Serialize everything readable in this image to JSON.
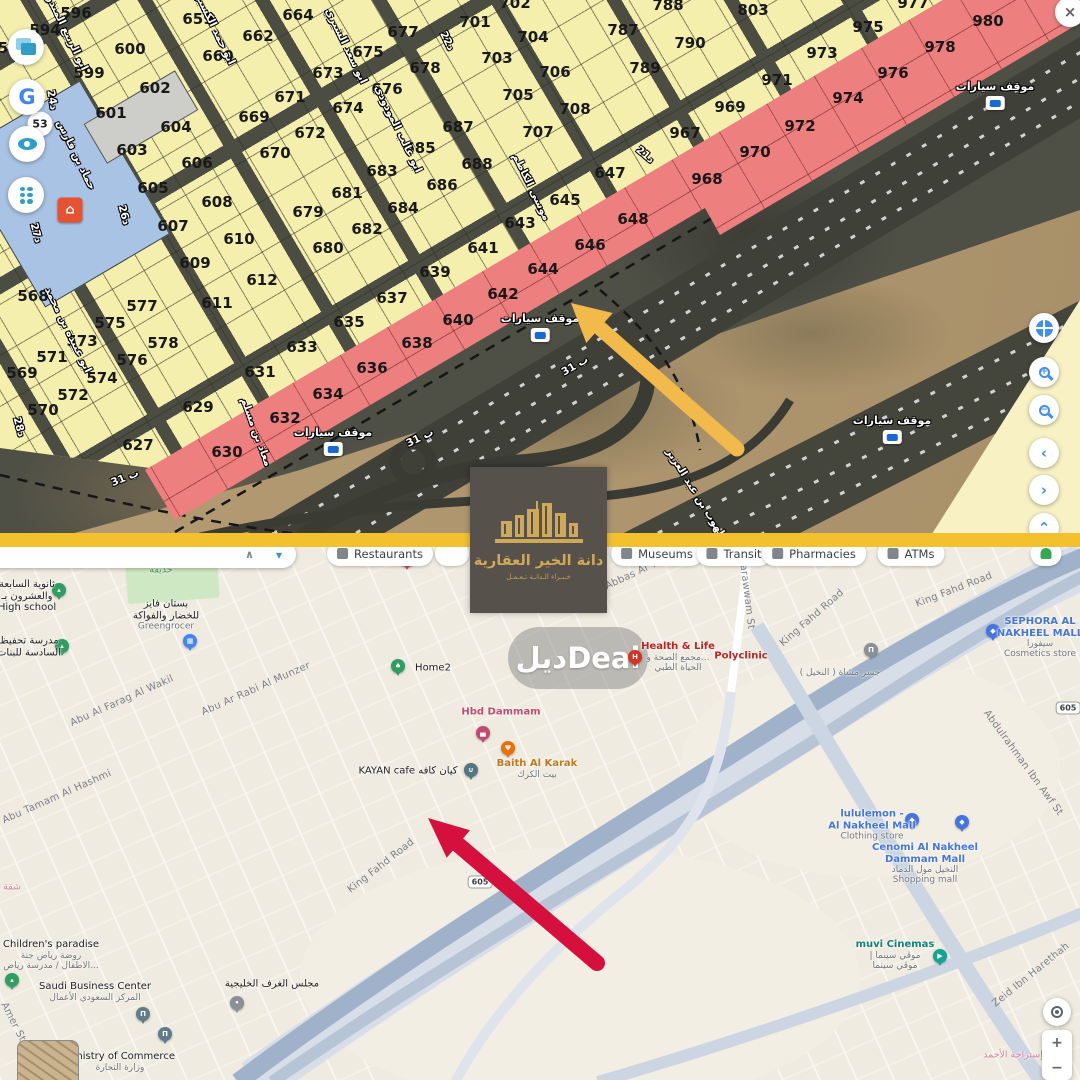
{
  "divider_color": "#f3c12e",
  "logo": {
    "title": "دانة الخير العقارية",
    "tagline": "خـبـراء الـدانـة تـعـمـل"
  },
  "watermark": {
    "text": "ديلDeal"
  },
  "top_map": {
    "badge_53": "53",
    "parking_label": "موقف سيارات",
    "parkings": [
      [
        995,
        95
      ],
      [
        540,
        327
      ],
      [
        892,
        429
      ],
      [
        333,
        441
      ]
    ],
    "parcels": [
      [
        "5",
        3,
        48,
        0
      ],
      [
        "594",
        45,
        30,
        0
      ],
      [
        "596",
        76,
        13,
        0
      ],
      [
        "599",
        89,
        73,
        0
      ],
      [
        "600",
        130,
        49,
        0
      ],
      [
        "601",
        111,
        113,
        0
      ],
      [
        "602",
        155,
        88,
        0
      ],
      [
        "603",
        132,
        150,
        0
      ],
      [
        "604",
        176,
        127,
        0
      ],
      [
        "605",
        153,
        188,
        0
      ],
      [
        "606",
        197,
        163,
        0
      ],
      [
        "607",
        173,
        226,
        0
      ],
      [
        "608",
        217,
        202,
        0
      ],
      [
        "609",
        195,
        263,
        0
      ],
      [
        "610",
        239,
        239,
        0
      ],
      [
        "611",
        217,
        303,
        0
      ],
      [
        "612",
        262,
        280,
        0
      ],
      [
        "627",
        138,
        445,
        0
      ],
      [
        "629",
        198,
        407,
        0
      ],
      [
        "630",
        227,
        452,
        1
      ],
      [
        "631",
        260,
        372,
        0
      ],
      [
        "632",
        285,
        418,
        1
      ],
      [
        "633",
        302,
        347,
        0
      ],
      [
        "634",
        328,
        394,
        1
      ],
      [
        "635",
        349,
        322,
        0
      ],
      [
        "636",
        372,
        368,
        1
      ],
      [
        "637",
        392,
        298,
        0
      ],
      [
        "638",
        417,
        343,
        1
      ],
      [
        "639",
        435,
        272,
        0
      ],
      [
        "640",
        458,
        320,
        1
      ],
      [
        "641",
        483,
        248,
        0
      ],
      [
        "642",
        503,
        294,
        1
      ],
      [
        "643",
        520,
        223,
        0
      ],
      [
        "644",
        543,
        269,
        1
      ],
      [
        "645",
        565,
        200,
        0
      ],
      [
        "646",
        590,
        245,
        1
      ],
      [
        "647",
        610,
        173,
        0
      ],
      [
        "648",
        633,
        219,
        1
      ],
      [
        "659",
        198,
        19,
        0
      ],
      [
        "660",
        218,
        56,
        0
      ],
      [
        "662",
        258,
        36,
        0
      ],
      [
        "664",
        298,
        15,
        0
      ],
      [
        "669",
        254,
        117,
        0
      ],
      [
        "670",
        275,
        153,
        0
      ],
      [
        "671",
        290,
        97,
        0
      ],
      [
        "672",
        310,
        133,
        0
      ],
      [
        "673",
        328,
        73,
        0
      ],
      [
        "674",
        348,
        108,
        0
      ],
      [
        "675",
        368,
        52,
        0
      ],
      [
        "676",
        387,
        89,
        0
      ],
      [
        "677",
        403,
        32,
        0
      ],
      [
        "678",
        425,
        68,
        0
      ],
      [
        "679",
        308,
        212,
        0
      ],
      [
        "680",
        328,
        248,
        0
      ],
      [
        "681",
        347,
        193,
        0
      ],
      [
        "682",
        367,
        229,
        0
      ],
      [
        "683",
        382,
        171,
        0
      ],
      [
        "684",
        403,
        208,
        0
      ],
      [
        "685",
        420,
        148,
        0
      ],
      [
        "686",
        442,
        185,
        0
      ],
      [
        "687",
        458,
        127,
        0
      ],
      [
        "688",
        477,
        164,
        0
      ],
      [
        "701",
        475,
        22,
        0
      ],
      [
        "702",
        515,
        3,
        0
      ],
      [
        "703",
        497,
        58,
        0
      ],
      [
        "704",
        533,
        37,
        0
      ],
      [
        "705",
        518,
        95,
        0
      ],
      [
        "706",
        555,
        72,
        0
      ],
      [
        "707",
        538,
        132,
        0
      ],
      [
        "708",
        575,
        109,
        0
      ],
      [
        "787",
        623,
        30,
        0
      ],
      [
        "788",
        668,
        5,
        0
      ],
      [
        "789",
        645,
        68,
        0
      ],
      [
        "790",
        690,
        43,
        0
      ],
      [
        "803",
        753,
        10,
        0
      ],
      [
        "967",
        685,
        133,
        0
      ],
      [
        "968",
        707,
        179,
        1
      ],
      [
        "969",
        730,
        107,
        0
      ],
      [
        "970",
        755,
        152,
        1
      ],
      [
        "971",
        777,
        80,
        0
      ],
      [
        "972",
        800,
        126,
        1
      ],
      [
        "973",
        822,
        53,
        0
      ],
      [
        "974",
        848,
        98,
        1
      ],
      [
        "975",
        868,
        27,
        0
      ],
      [
        "976",
        893,
        73,
        1
      ],
      [
        "977",
        913,
        3,
        1
      ],
      [
        "978",
        940,
        47,
        1
      ],
      [
        "980",
        988,
        21,
        1
      ],
      [
        "568",
        33,
        296,
        0
      ],
      [
        "569",
        22,
        373,
        0
      ],
      [
        "570",
        43,
        410,
        0
      ],
      [
        "571",
        52,
        357,
        0
      ],
      [
        "572",
        73,
        395,
        0
      ],
      [
        "573",
        82,
        341,
        0
      ],
      [
        "574",
        102,
        378,
        0
      ],
      [
        "575",
        110,
        323,
        0
      ],
      [
        "576",
        132,
        360,
        0
      ],
      [
        "577",
        142,
        306,
        0
      ],
      [
        "578",
        163,
        343,
        0
      ]
    ],
    "street_labels": [
      [
        "ابو الربيع المنذر",
        67,
        33,
        64
      ],
      [
        "ابو حمد الكسبري",
        213,
        25,
        64
      ],
      [
        "ابو سعد الشيري",
        346,
        46,
        64
      ],
      [
        "22د",
        447,
        41,
        64
      ],
      [
        "24د",
        52,
        100,
        80
      ],
      [
        "حماد بن فارس",
        76,
        155,
        64
      ],
      [
        "ابو عبيدة بن محمد",
        68,
        330,
        64
      ],
      [
        "ابو غالب المودودي",
        398,
        129,
        64
      ],
      [
        "موسى الكاظم",
        531,
        187,
        64
      ],
      [
        "21د",
        645,
        155,
        40
      ],
      [
        "26د",
        124,
        215,
        75
      ],
      [
        "27د",
        36,
        233,
        75
      ],
      [
        "28د",
        19,
        427,
        75
      ],
      [
        "معاذ بن مسلم",
        256,
        432,
        70
      ],
      [
        "ب 31",
        125,
        478,
        -22
      ],
      [
        "ب 31",
        420,
        438,
        -26
      ],
      [
        "31 ب",
        575,
        366,
        -30
      ],
      [
        "الشلهوب بن عبد العزيز",
        700,
        500,
        58
      ]
    ],
    "controls_left": [
      {
        "icon": "layers-icon",
        "x": 26,
        "y": 47
      },
      {
        "icon": "google-g-icon",
        "x": 27,
        "y": 97,
        "glyph": "G"
      },
      {
        "icon": "eye-icon",
        "x": 27,
        "y": 144
      },
      {
        "icon": "traffic-light-icon",
        "x": 26,
        "y": 195
      }
    ],
    "controls_right": [
      {
        "icon": "globe-icon",
        "x": 1044,
        "y": 328
      },
      {
        "icon": "zoom-in-icon",
        "x": 1044,
        "y": 372,
        "glyph": "+"
      },
      {
        "icon": "zoom-out-icon",
        "x": 1044,
        "y": 410,
        "glyph": "−"
      },
      {
        "icon": "chevron-left-icon",
        "x": 1044,
        "y": 453,
        "glyph": "‹"
      },
      {
        "icon": "chevron-right-icon",
        "x": 1044,
        "y": 490,
        "glyph": "›"
      },
      {
        "icon": "chevron-up-icon",
        "x": 1044,
        "y": 528,
        "glyph": "⌃"
      },
      {
        "icon": "close-icon",
        "x": 1070,
        "y": 12,
        "glyph": "×"
      }
    ]
  },
  "bottom_map": {
    "search": {
      "caret": "∧",
      "dropdown": "▾"
    },
    "chips": [
      {
        "t": "Restaurants",
        "x": 380,
        "ic": "gray"
      },
      {
        "t": "",
        "x": 452,
        "ic": ""
      },
      {
        "t": "Museums",
        "x": 657,
        "ic": "gray"
      },
      {
        "t": "Transit",
        "x": 734,
        "ic": "gray"
      },
      {
        "t": "Pharmacies",
        "x": 814,
        "ic": "gray"
      },
      {
        "t": "ATMs",
        "x": 911,
        "ic": "gray"
      },
      {
        "t": "",
        "x": 1046,
        "ic": "green"
      }
    ],
    "route_badges": [
      {
        "t": "605",
        "x": 480,
        "y": 882
      },
      {
        "t": "605",
        "x": 1068,
        "y": 708
      }
    ],
    "street_labels": [
      [
        "Abu Abbas Al Yamany",
        636,
        573,
        -25
      ],
      [
        "arawwam St",
        747,
        597,
        83
      ],
      [
        "King Fahd Road",
        812,
        618,
        -41
      ],
      [
        "King Fahd Road",
        954,
        590,
        -21
      ],
      [
        "King Fahd Road",
        381,
        866,
        -38
      ],
      [
        "Abdulrahman Ibn Awf St",
        1023,
        763,
        54
      ],
      [
        "Zeid Ibn Harethah",
        1031,
        975,
        -39
      ],
      [
        "Abu Al Farag Al Wakil",
        122,
        701,
        -24
      ],
      [
        "Abu Ar Rabi Al Munzer",
        256,
        689,
        -24
      ],
      [
        "Abu Tamam Al Hashmi",
        57,
        797,
        -24
      ],
      [
        "Amer St",
        13,
        1022,
        63
      ]
    ],
    "pois": [
      {
        "p": [
          59,
          590,
          "green",
          "school"
        ],
        "l": [
          27,
          596
        ],
        "ln": [
          [
            "ثانوية السابعة",
            "dark"
          ],
          [
            "والعشرون بـ",
            "dark"
          ],
          [
            "High school",
            "dark"
          ]
        ]
      },
      {
        "p": [
          190,
          641,
          "blue",
          "cart"
        ],
        "l": [
          166,
          615
        ],
        "ln": [
          [
            "بستان فايز",
            "dark"
          ],
          [
            "للخضار والفواكة",
            "dark"
          ],
          [
            "Greengrocer",
            "gray"
          ]
        ]
      },
      {
        "p": null,
        "l": [
          161,
          571
        ],
        "ln": [
          [
            "حديقة",
            "green"
          ]
        ]
      },
      {
        "p": [
          62,
          646,
          "green",
          "school"
        ],
        "l": [
          29,
          647
        ],
        "ln": [
          [
            "مدرسة تحفيظ",
            "dark"
          ],
          [
            "السادسة للبنات",
            "dark"
          ]
        ]
      },
      {
        "p": [
          398,
          666,
          "green",
          "tree"
        ],
        "l": [
          433,
          668
        ],
        "ln": [
          [
            "Home2",
            "dark"
          ]
        ]
      },
      {
        "p": [
          483,
          733,
          "pink",
          "bed"
        ],
        "l": [
          501,
          712
        ],
        "ln": [
          [
            "Hbd Dammam",
            "pink"
          ]
        ]
      },
      {
        "p": [
          508,
          748,
          "orange",
          "fork"
        ],
        "l": [
          537,
          769
        ],
        "ln": [
          [
            "Baith Al Karak",
            "orange"
          ],
          [
            "بيت الكرك",
            "gray"
          ]
        ]
      },
      {
        "p": [
          471,
          770,
          "cafe",
          "cup"
        ],
        "l": [
          408,
          771
        ],
        "ln": [
          [
            "KAYAN cafe كيان كافه",
            "dark"
          ]
        ]
      },
      {
        "p": [
          635,
          657,
          "red",
          "H"
        ],
        "l": [
          678,
          657
        ],
        "ln": [
          [
            "Health & Life",
            "red"
          ],
          [
            "مجمع الصحة و...",
            "gray"
          ],
          [
            "الحياة الطبي",
            "gray"
          ]
        ]
      },
      {
        "p": null,
        "l": [
          741,
          656
        ],
        "ln": [
          [
            "Polyclinic",
            "red"
          ]
        ]
      },
      {
        "p": [
          871,
          650,
          "gray",
          "bridge"
        ],
        "l": [
          840,
          673
        ],
        "ln": [
          [
            "جسر مشاة ( النخيل )",
            "gray"
          ]
        ]
      },
      {
        "p": [
          993,
          631,
          "shop",
          "bag"
        ],
        "l": [
          1040,
          638
        ],
        "ln": [
          [
            "SEPHORA AL",
            "blue"
          ],
          [
            "NAKHEEL MALL",
            "blue"
          ],
          [
            "سيفورا",
            "gray"
          ],
          [
            "Cosmetics store",
            "gray"
          ]
        ]
      },
      {
        "p": [
          407,
          560,
          "pink",
          "bed"
        ],
        "l": null,
        "ln": []
      },
      {
        "p": [
          912,
          820,
          "shop",
          "bag"
        ],
        "l": [
          872,
          825
        ],
        "ln": [
          [
            "lululemon -",
            "blue"
          ],
          [
            "Al Nakheel Mall",
            "blue"
          ],
          [
            "Clothing store",
            "gray"
          ]
        ]
      },
      {
        "p": [
          962,
          822,
          "shop",
          "bag"
        ],
        "l": [
          925,
          864
        ],
        "ln": [
          [
            "Cenomi Al Nakheel",
            "blue"
          ],
          [
            "Dammam Mall",
            "blue"
          ],
          [
            "النخيل مول الدماد",
            "gray"
          ],
          [
            "Shopping mall",
            "gray"
          ]
        ]
      },
      {
        "p": [
          940,
          956,
          "teal",
          "film"
        ],
        "l": [
          895,
          955
        ],
        "ln": [
          [
            "muvi Cinemas",
            "teal"
          ],
          [
            "| موڤي سينما",
            "gray"
          ],
          [
            "موڤي سينما",
            "gray"
          ]
        ]
      },
      {
        "p": [
          12,
          980,
          "green",
          "school"
        ],
        "l": [
          51,
          955
        ],
        "ln": [
          [
            "Children's paradise",
            "dark"
          ],
          [
            "روضة رياض جنة",
            "gray"
          ],
          [
            "الاطفال / مدرسة رياض...",
            "gray"
          ]
        ]
      },
      {
        "p": [
          143,
          1014,
          "bank",
          "bank"
        ],
        "l": [
          95,
          992
        ],
        "ln": [
          [
            "Saudi Business Center",
            "dark"
          ],
          [
            "المركز السعودي الأعمال",
            "gray"
          ]
        ]
      },
      {
        "p": [
          165,
          1034,
          "bank",
          "bank"
        ],
        "l": [
          120,
          1062
        ],
        "ln": [
          [
            "Ministry of Commerce",
            "dark"
          ],
          [
            "وزارة التجارة",
            "gray"
          ]
        ]
      },
      {
        "p": [
          237,
          1003,
          "gray",
          "dot"
        ],
        "l": [
          272,
          984
        ],
        "ln": [
          [
            "مجلس الغرف الخليجية",
            "dark"
          ]
        ]
      },
      {
        "p": null,
        "l": [
          12,
          888
        ],
        "ln": [
          [
            "شقة",
            "pinkarea"
          ]
        ]
      },
      {
        "p": null,
        "l": [
          1013,
          1056
        ],
        "ln": [
          [
            "إستراحة الأحمد",
            "pinkarea"
          ]
        ]
      }
    ],
    "controls": [
      {
        "icon": "my-location-icon",
        "x": 1057,
        "y": 1012
      },
      {
        "icon": "zoom-in-icon",
        "glyph": "+"
      },
      {
        "icon": "zoom-out-icon",
        "glyph": "−"
      }
    ]
  }
}
